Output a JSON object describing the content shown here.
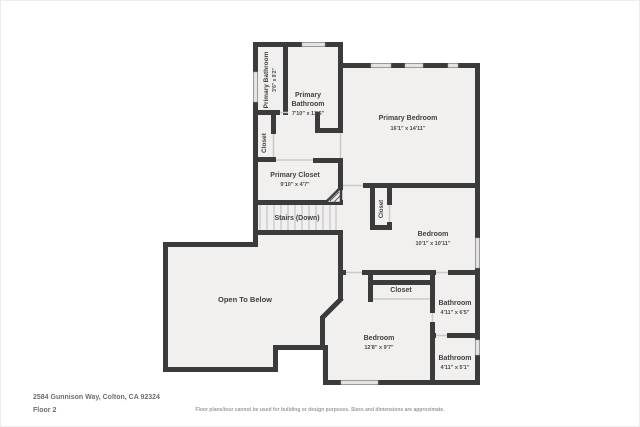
{
  "meta": {
    "address": "2584 Gunnison Way, Colton, CA 92324",
    "floor_label": "Floor 2",
    "disclaimer": "Floor plans/tour cannot be used for building or design purposes. Sizes and dimensions are approximate."
  },
  "colors": {
    "wall": "#3b3b3b",
    "floor": "#f1f0ef",
    "door_line": "#c9c9c9",
    "window": "#e4e4e4",
    "label": "#3f3f3f"
  },
  "rooms": {
    "primary_bathroom_small": {
      "name": "Primary Bathroom",
      "dims": "3'6\" x 8'2\""
    },
    "primary_bathroom": {
      "line1": "Primary",
      "line2": "Bathroom",
      "dims": "7'10\" x 13'5\""
    },
    "primary_bedroom": {
      "name": "Primary Bedroom",
      "dims": "16'1\" x 14'11\""
    },
    "closet_hall": {
      "name": "Closet"
    },
    "primary_closet": {
      "name": "Primary Closet",
      "dims": "9'10\" x 4'7\""
    },
    "stairs": {
      "name": "Stairs (Down)"
    },
    "bedroom_closet": {
      "name": "Closet"
    },
    "bedroom_ne": {
      "name": "Bedroom",
      "dims": "10'1\" x 10'11\""
    },
    "open_to_below": {
      "name": "Open To Below"
    },
    "closet_south": {
      "name": "Closet"
    },
    "bathroom_upper": {
      "name": "Bathroom",
      "dims": "4'11\" x 6'5\""
    },
    "bedroom_south": {
      "name": "Bedroom",
      "dims": "12'8\" x 9'7\""
    },
    "bathroom_lower": {
      "name": "Bathroom",
      "dims": "4'11\" x 5'1\""
    }
  }
}
